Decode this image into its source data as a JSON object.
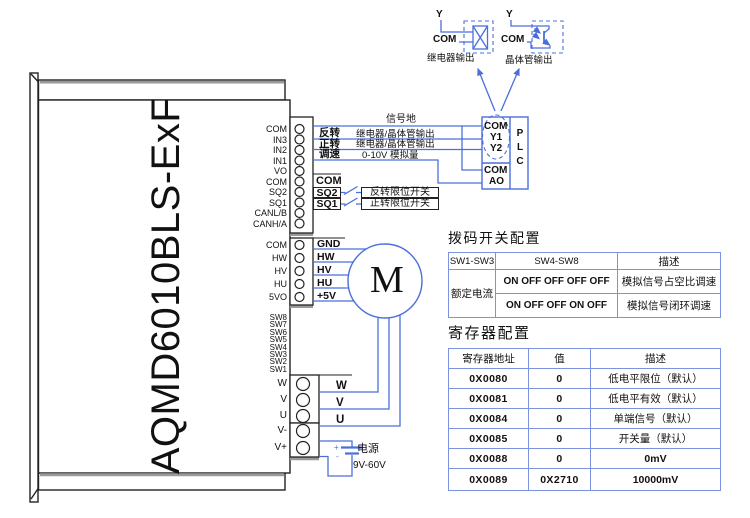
{
  "device": {
    "model": "AQMD6010BLS-ExF"
  },
  "terminals": {
    "block1": [
      "COM",
      "IN3",
      "IN2",
      "IN1",
      "VO",
      "COM",
      "SQ2",
      "SQ1",
      "CANL/B",
      "CANH/A"
    ],
    "block2": [
      "COM",
      "HW",
      "HV",
      "HU",
      "5VO"
    ],
    "dip": [
      "SW8",
      "SW7",
      "SW6",
      "SW5",
      "SW4",
      "SW3",
      "SW2",
      "SW1"
    ],
    "block3": [
      "W",
      "V",
      "U"
    ],
    "block4": [
      "V-",
      "V+"
    ]
  },
  "wiring": {
    "signal_ground": "信号地",
    "reverse": "反转",
    "reverse_desc": "继电器/晶体管输出",
    "forward": "正转",
    "forward_desc": "继电器/晶体管输出",
    "speed": "调速",
    "speed_desc": "0-10V 模拟量",
    "com": "COM",
    "sq2": "SQ2",
    "sq2_desc": "反转限位开关",
    "sq1": "SQ1",
    "sq1_desc": "正转限位开关",
    "hall": [
      "GND",
      "HW",
      "HV",
      "HU",
      "+5V"
    ],
    "phase": [
      "W",
      "V",
      "U"
    ],
    "motor": "M",
    "power": {
      "label": "电源",
      "range": "9V-60V",
      "plus": "+",
      "minus": "-"
    }
  },
  "plc": {
    "com1": "COM",
    "y1": "Y1",
    "y2": "Y2",
    "com2": "COM",
    "ao": "AO",
    "letters": [
      "P",
      "L",
      "C"
    ]
  },
  "outputs": {
    "relay": {
      "y": "Y",
      "com": "COM",
      "label": "继电器输出"
    },
    "transistor": {
      "y": "Y",
      "com": "COM",
      "label": "晶体管输出"
    }
  },
  "dip_table": {
    "title": "拨码开关配置",
    "headers": [
      "SW1-SW3",
      "SW4-SW8",
      "描述"
    ],
    "col1": "额定电流",
    "rows": [
      {
        "sw": "ON OFF OFF OFF OFF",
        "desc": "模拟信号占空比调速"
      },
      {
        "sw": "ON OFF OFF ON OFF",
        "desc": "模拟信号闭环调速"
      }
    ]
  },
  "reg_table": {
    "title": "寄存器配置",
    "headers": [
      "寄存器地址",
      "值",
      "描述"
    ],
    "rows": [
      [
        "0X0080",
        "0",
        "低电平限位（默认）"
      ],
      [
        "0X0081",
        "0",
        "低电平有效（默认）"
      ],
      [
        "0X0084",
        "0",
        "单端信号（默认）"
      ],
      [
        "0X0085",
        "0",
        "开关量（默认）"
      ],
      [
        "0X0088",
        "0",
        "0mV"
      ],
      [
        "0X0089",
        "0X2710",
        "10000mV"
      ]
    ]
  },
  "colors": {
    "wire": "#4a6fdc",
    "table_border": "#7b93e0"
  }
}
